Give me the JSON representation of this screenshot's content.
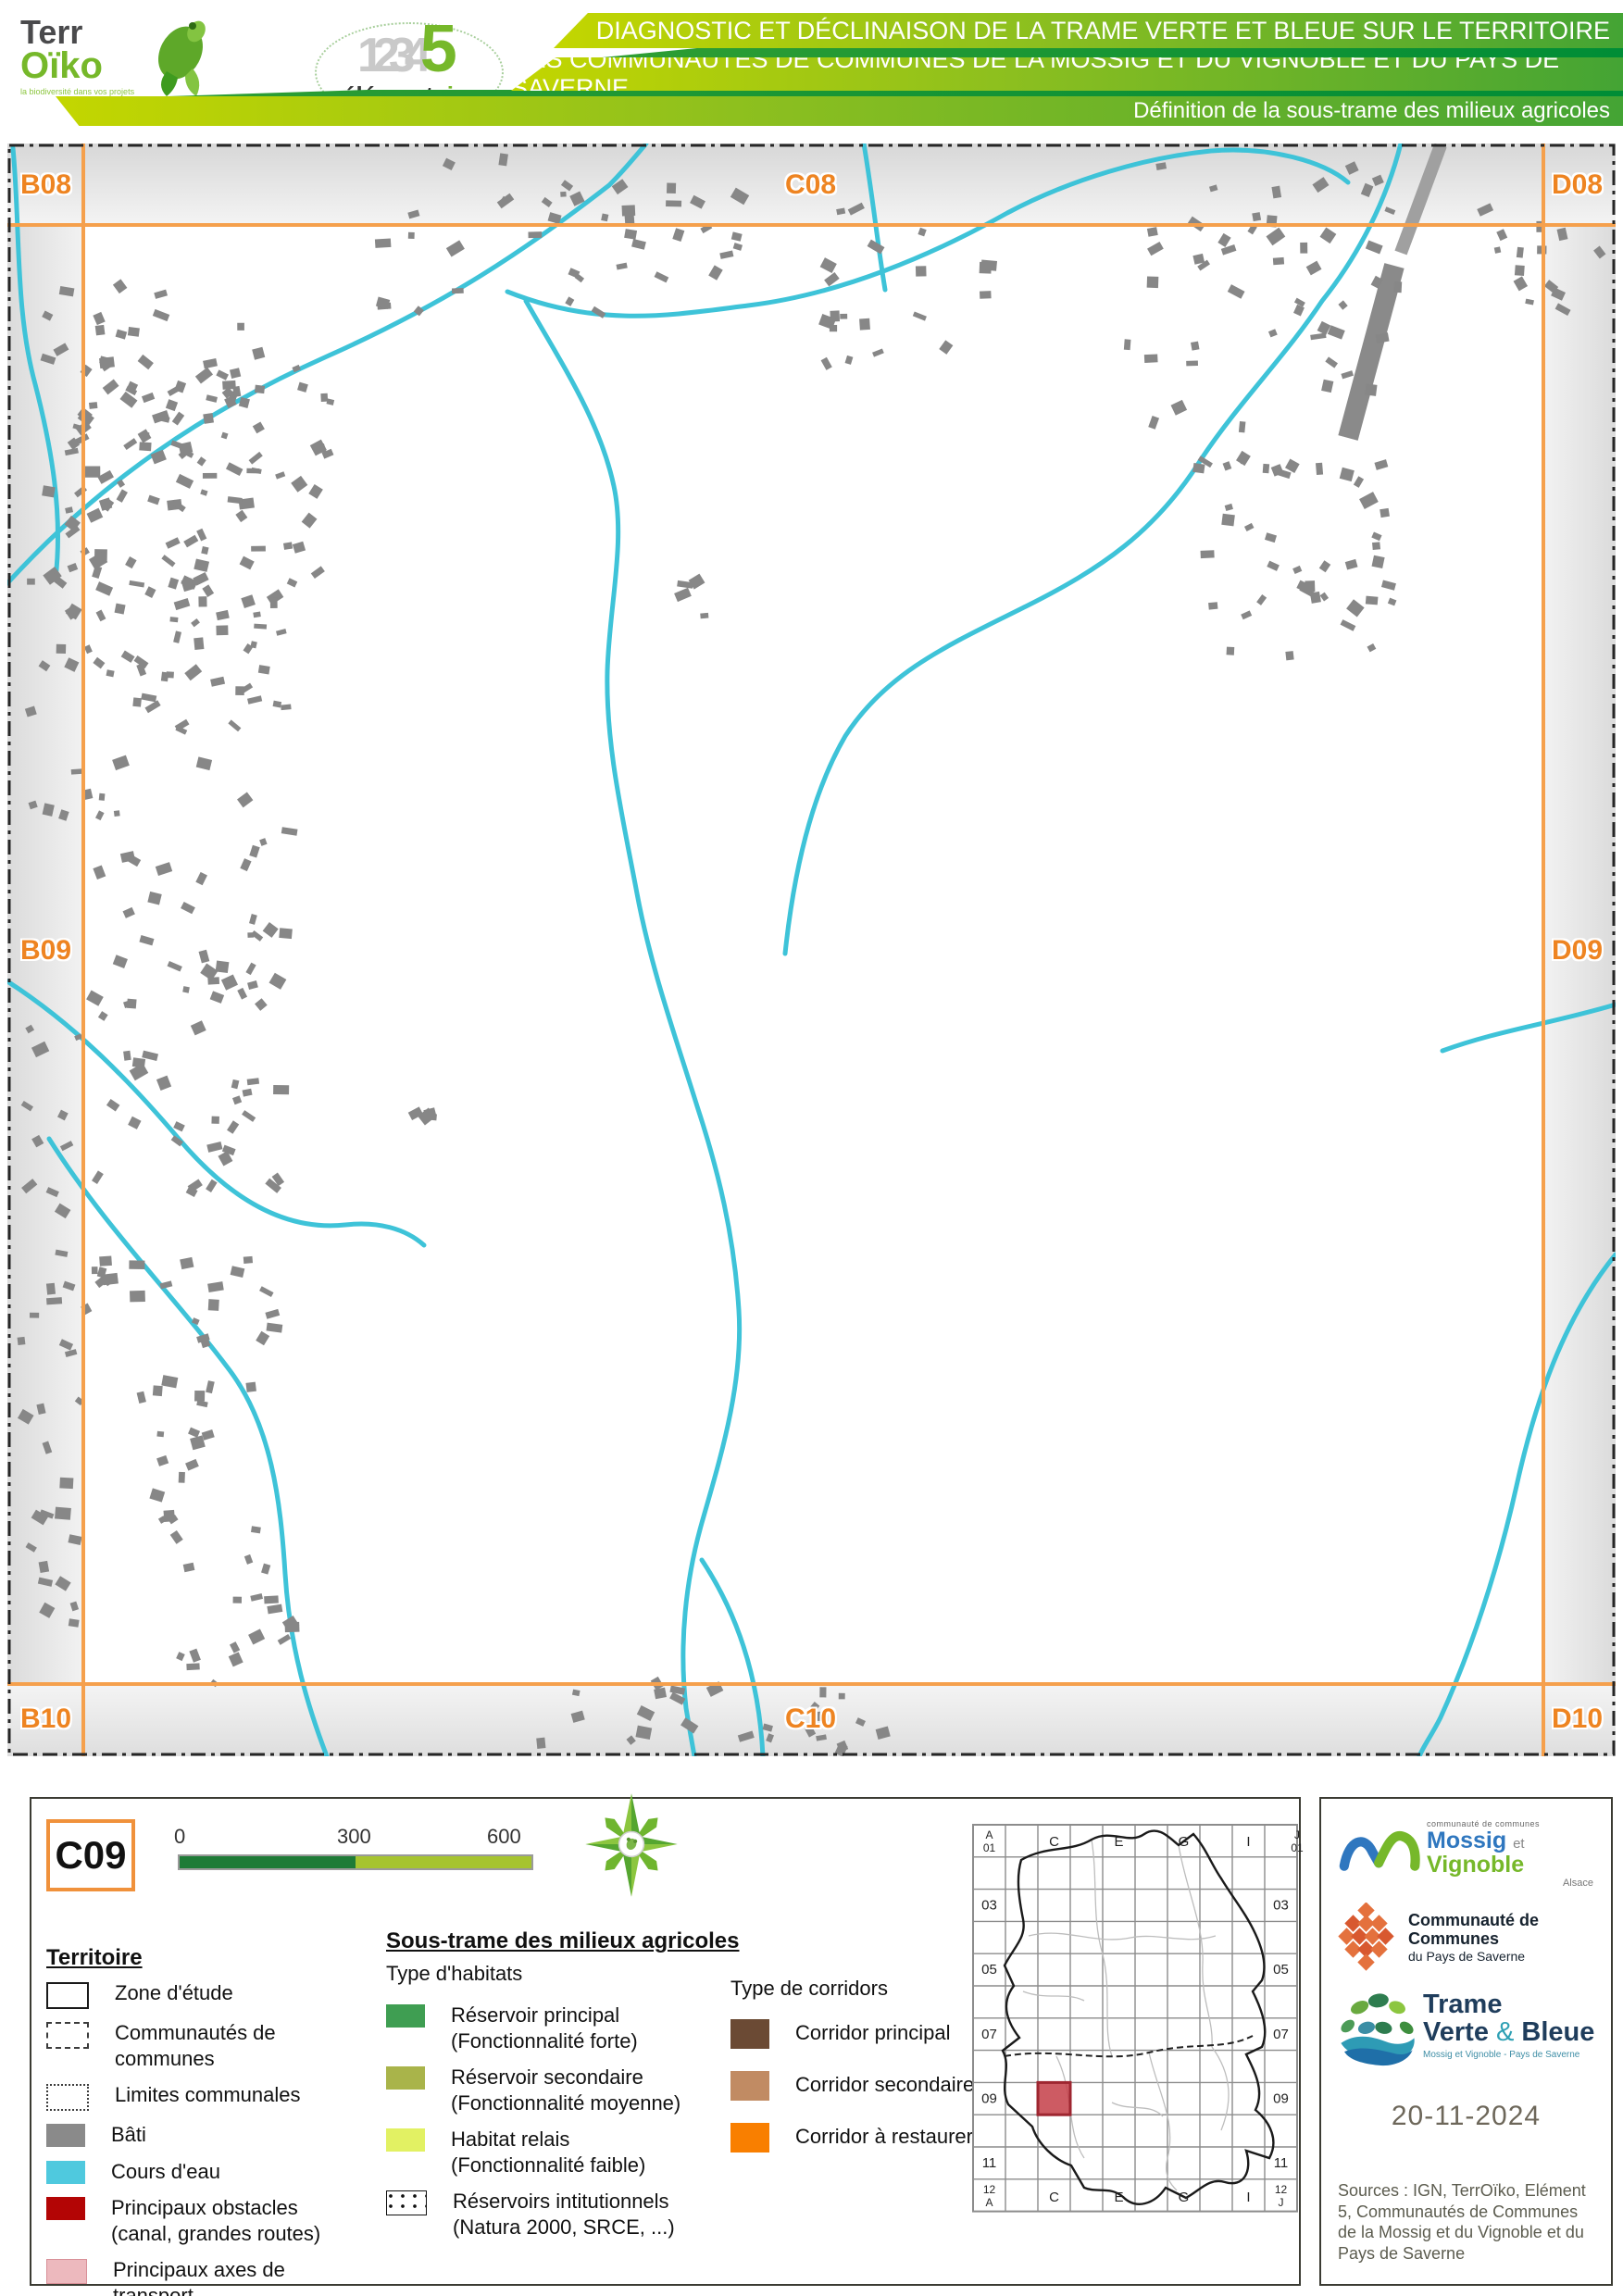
{
  "header": {
    "terroiko": {
      "line1": "Terr",
      "line2": "Oïko",
      "tagline": "la biodiversité dans vos projets"
    },
    "element5": {
      "numbers": "1234",
      "five": "5",
      "word": "élément",
      "word2": "cinq"
    },
    "title_line1": "DIAGNOSTIC ET DÉCLINAISON DE LA TRAME VERTE ET BLEUE SUR LE TERRITOIRE",
    "title_line2": "DES COMMUNAUTÉS DE COMMUNES DE LA MOSSIG ET DU VIGNOBLE ET DU PAYS DE SAVERNE",
    "subtitle": "Définition de la sous-trame des milieux agricoles"
  },
  "map": {
    "labels": {
      "b08": "B08",
      "c08": "C08",
      "d08": "D08",
      "b09": "B09",
      "d09": "D09",
      "b10": "B10",
      "c10": "C10",
      "d10": "D10"
    }
  },
  "legend": {
    "cell_id": "C09",
    "scale_ticks": [
      "0",
      "300",
      "600 m"
    ],
    "territoire_title": "Territoire",
    "territoire_items": [
      {
        "label": "Zone d'étude",
        "sub": ""
      },
      {
        "label": "Communautés de",
        "sub": "communes"
      },
      {
        "label": "Limites communales",
        "sub": ""
      },
      {
        "label": "Bâti",
        "sub": ""
      },
      {
        "label": "Cours d'eau",
        "sub": ""
      },
      {
        "label": "Principaux obstacles",
        "sub": "(canal, grandes routes)"
      },
      {
        "label": "Principaux axes de transport",
        "sub": ""
      }
    ],
    "soustrame_title": "Sous-trame des milieux agricoles",
    "habitats_title": "Type d'habitats",
    "habitat_items": [
      {
        "label": "Réservoir principal",
        "sub": "(Fonctionnalité forte)"
      },
      {
        "label": "Réservoir secondaire",
        "sub": "(Fonctionnalité moyenne)"
      },
      {
        "label": "Habitat relais",
        "sub": "(Fonctionnalité faible)"
      },
      {
        "label": "Réservoirs intitutionnels",
        "sub": "(Natura 2000, SRCE, ...)"
      }
    ],
    "corridors_title": "Type de corridors",
    "corridor_items": [
      {
        "label": "Corridor principal"
      },
      {
        "label": "Corridor secondaire"
      },
      {
        "label": "Corridor à restaurer"
      }
    ],
    "index_map": {
      "corner_tl": [
        "A",
        "01"
      ],
      "corner_tr": [
        "J",
        "01"
      ],
      "corner_bl": [
        "12",
        "A"
      ],
      "corner_br": [
        "12",
        "J"
      ],
      "top_letters": [
        "C",
        "E",
        "G",
        "I"
      ],
      "bottom_letters": [
        "C",
        "E",
        "G",
        "I"
      ],
      "side_numbers": [
        "03",
        "05",
        "07",
        "09",
        "11"
      ],
      "highlight": {
        "col": "C",
        "row": "09"
      }
    }
  },
  "partners": {
    "mossig": {
      "small": "communauté de communes",
      "name1": "Mossig",
      "et": "et",
      "name2": "Vignoble",
      "region": "Alsace"
    },
    "saverne": {
      "line1": "Communauté de Communes",
      "line2": "du Pays de Saverne"
    },
    "tvb": {
      "line1": "Trame",
      "line2a": "Verte",
      "amp": "&",
      "line2b": "Bleue",
      "sub": "Mossig et Vignoble - Pays de Saverne"
    },
    "date": "20-11-2024",
    "sources": "Sources : IGN, TerrOïko, Elément 5, Communautés de Communes de la Mossig et du Vignoble et du Pays de Saverne"
  },
  "colors": {
    "accent_orange_grid": "#f5a04c",
    "label_orange": "#ee8421",
    "river": "#3ec3d8",
    "building": "#878787",
    "header_green_light": "#c3d600",
    "header_green_dark": "#44a434",
    "scale_dark": "#1e7b37",
    "scale_light": "#a6c42f",
    "highlight_red": "#c4535c"
  }
}
